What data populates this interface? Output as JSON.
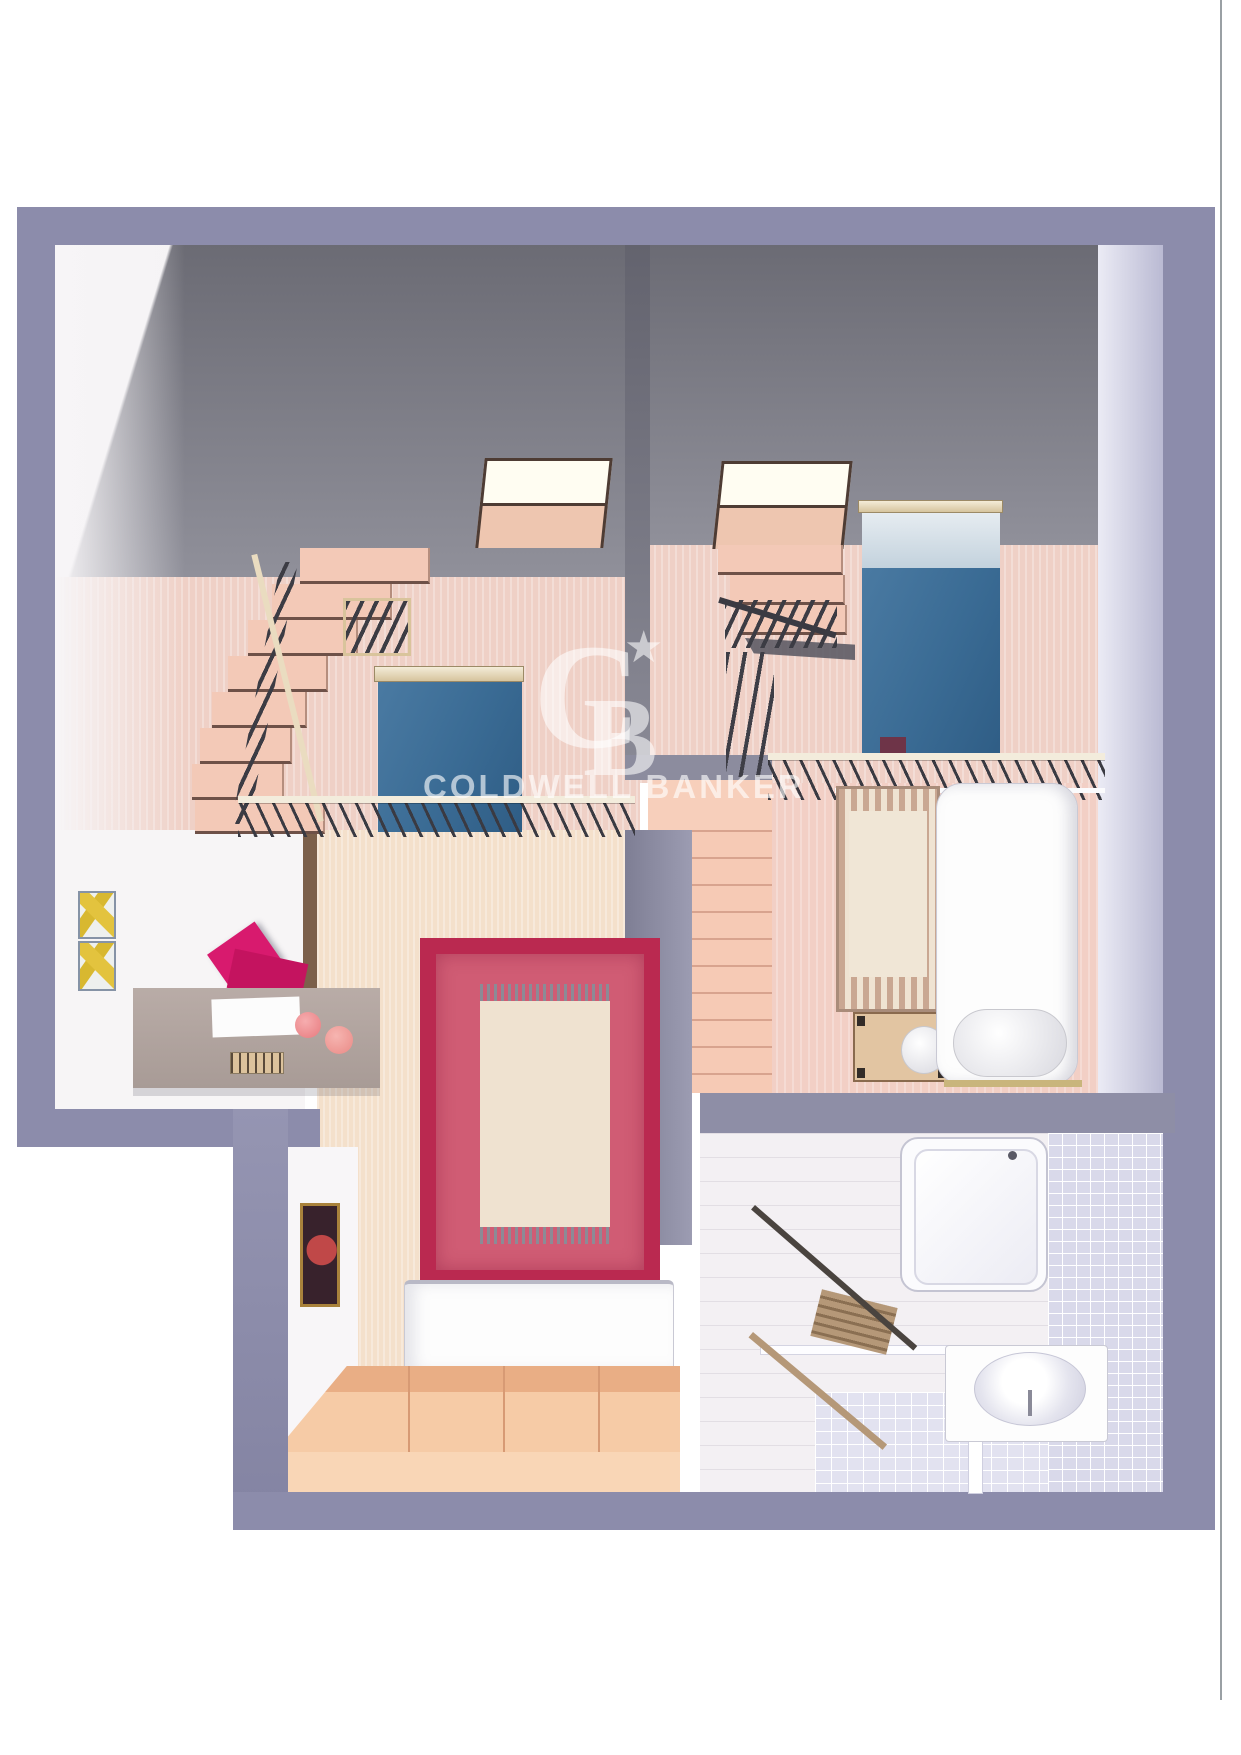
{
  "title": "3D floor plan rendering",
  "watermark": {
    "brand": "COLDWELL BANKER",
    "monogram_c": "C",
    "monogram_b": "B",
    "star": "★"
  },
  "colors": {
    "wall_outer": "#8c8cab",
    "wall_dark": "#73737c",
    "floor_pink": "#efd0c6",
    "floor_beige": "#f4e0cb",
    "floor_salmon": "#f6cab5",
    "rug_red": "#ba2950",
    "rug_red_inner": "#d05c74",
    "rug_center": "#efe2d0",
    "bed_blue": "#42729a",
    "chair_magenta": "#d81a6e",
    "platform_peach": "#f5c9a3",
    "tile": "#d9d9ea"
  }
}
